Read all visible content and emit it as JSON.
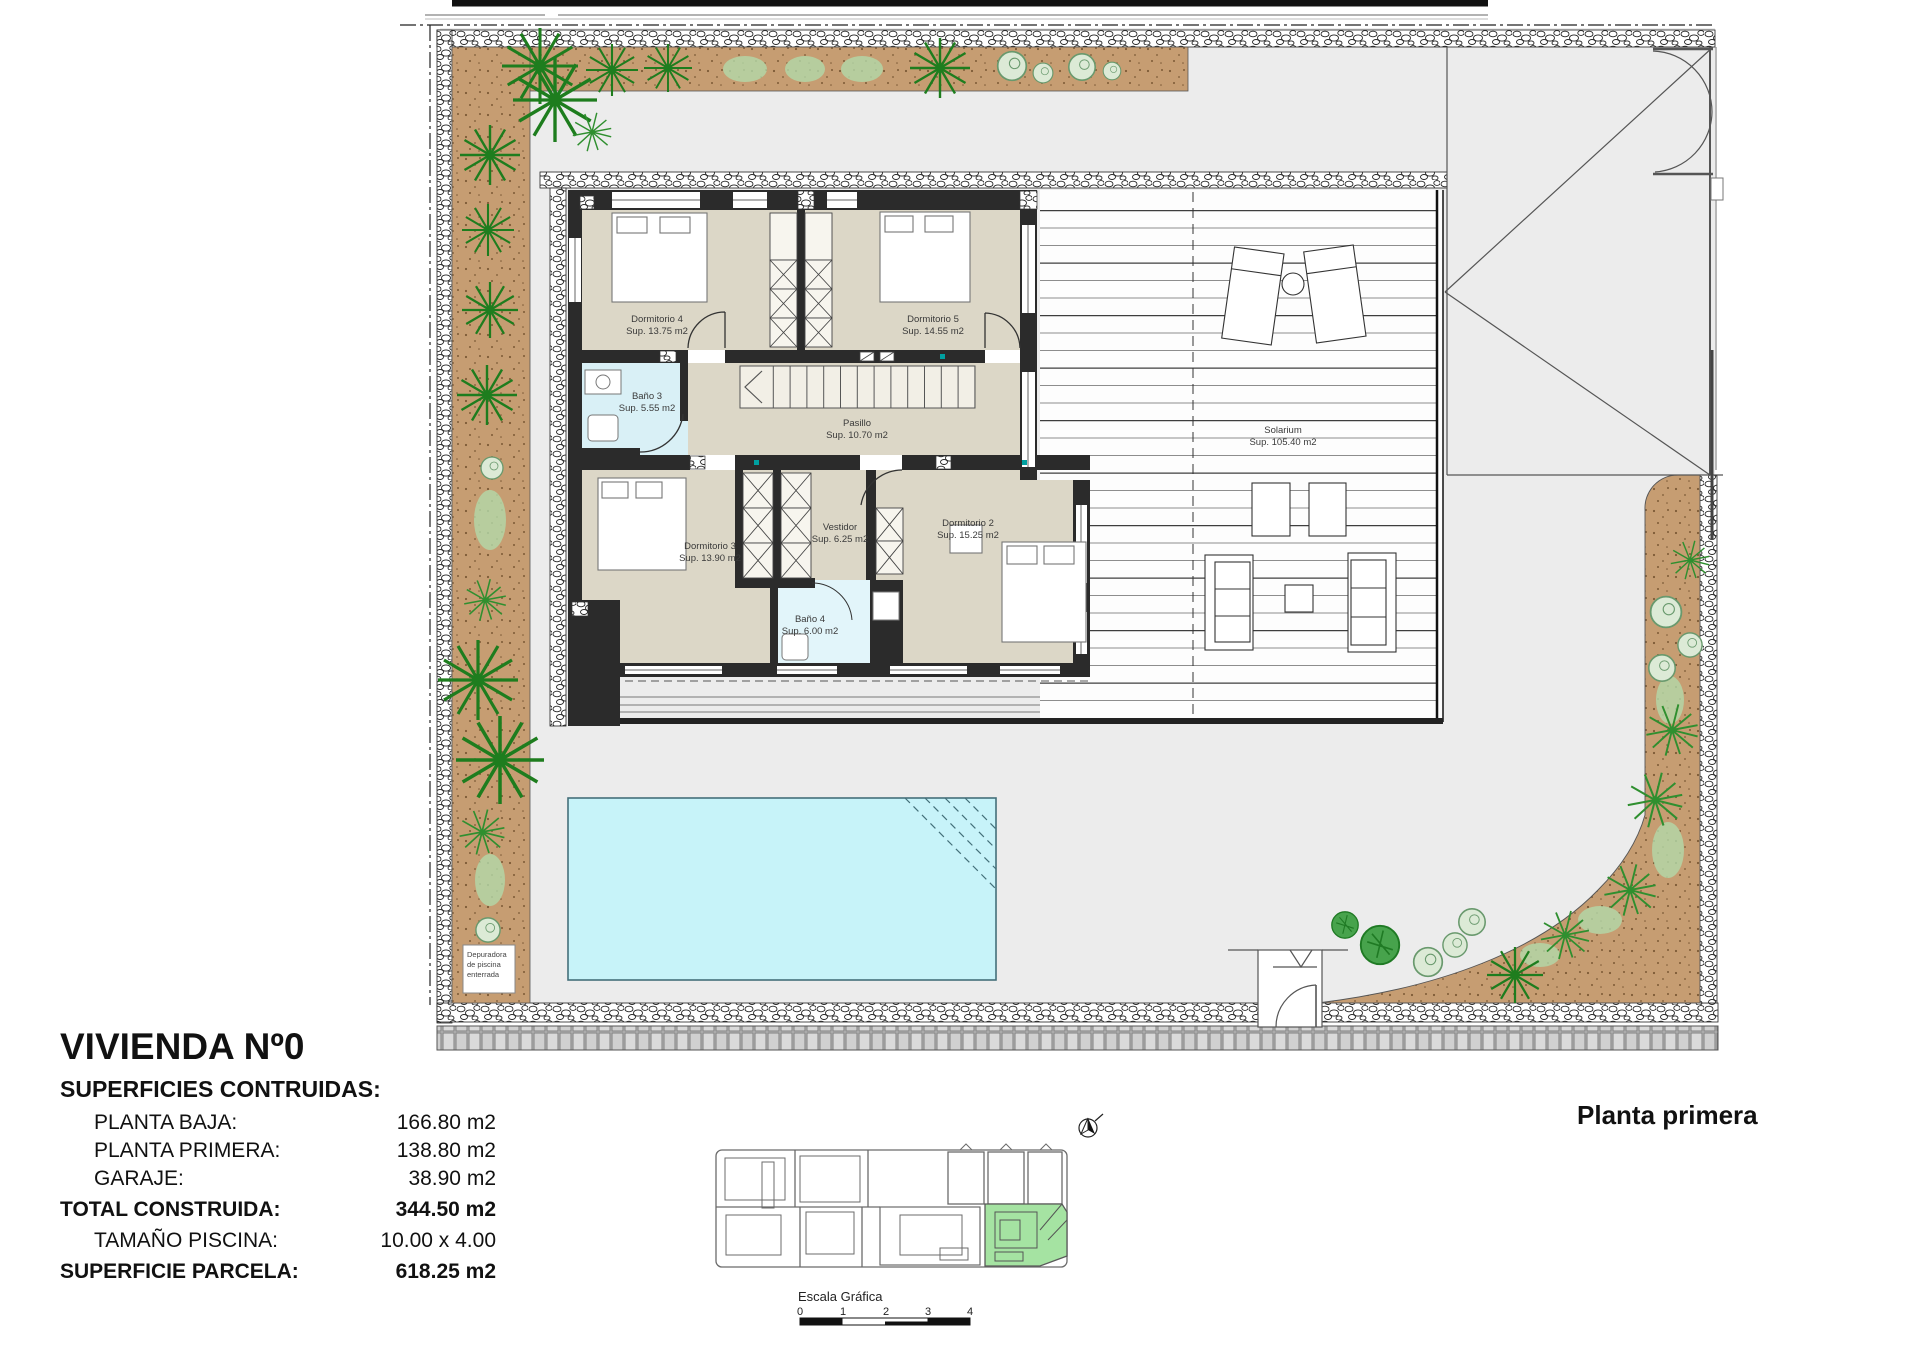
{
  "drawing": {
    "rooms": {
      "dormitorio4": {
        "name": "Dormitorio 4",
        "area": "Sup. 13.75 m2"
      },
      "dormitorio5": {
        "name": "Dormitorio 5",
        "area": "Sup. 14.55 m2"
      },
      "bano3": {
        "name": "Baño 3",
        "area": "Sup. 5.55 m2"
      },
      "pasillo": {
        "name": "Pasillo",
        "area": "Sup. 10.70 m2"
      },
      "dormitorio3": {
        "name": "Dormitorio 3",
        "area": "Sup. 13.90 m2"
      },
      "vestidor": {
        "name": "Vestidor",
        "area": "Sup. 6.25 m2"
      },
      "dormitorio2": {
        "name": "Dormitorio 2",
        "area": "Sup. 15.25 m2"
      },
      "bano4": {
        "name": "Baño 4",
        "area": "Sup. 6.00 m2"
      },
      "solarium": {
        "name": "Solarium",
        "area": "Sup. 105.40 m2"
      }
    },
    "pool_note": {
      "line1": "Depuradora",
      "line2": "de piscina",
      "line3": "enterrada"
    }
  },
  "title_block": {
    "title": "VIVIENDA Nº0",
    "subtitle": "SUPERFICIES CONTRUIDAS:",
    "rows": [
      {
        "label": "PLANTA BAJA:",
        "value": "166.80 m2"
      },
      {
        "label": "PLANTA PRIMERA:",
        "value": "138.80 m2"
      },
      {
        "label": "GARAJE:",
        "value": "38.90 m2"
      },
      {
        "label": "TOTAL CONSTRUIDA:",
        "value": "344.50 m2"
      },
      {
        "label": "TAMAÑO PISCINA:",
        "value": "10.00 x 4.00"
      },
      {
        "label": "SUPERFICIE PARCELA:",
        "value": "618.25 m2"
      }
    ]
  },
  "plan_label": "Planta primera",
  "scale_bar": {
    "title": "Escala Gráfica",
    "ticks": [
      "0",
      "1",
      "2",
      "3",
      "4"
    ]
  },
  "colors": {
    "floor_beige": "#dcd7c7",
    "wall_dark": "#2b2b2b",
    "bath_blue": "#d9f0f6",
    "pool_cyan": "#c7f3f9",
    "soil_tan": "#c69d72",
    "plot_grey": "#ececec",
    "highlight_green": "#a5e3a2",
    "accent_teal": "#00a0a0"
  }
}
